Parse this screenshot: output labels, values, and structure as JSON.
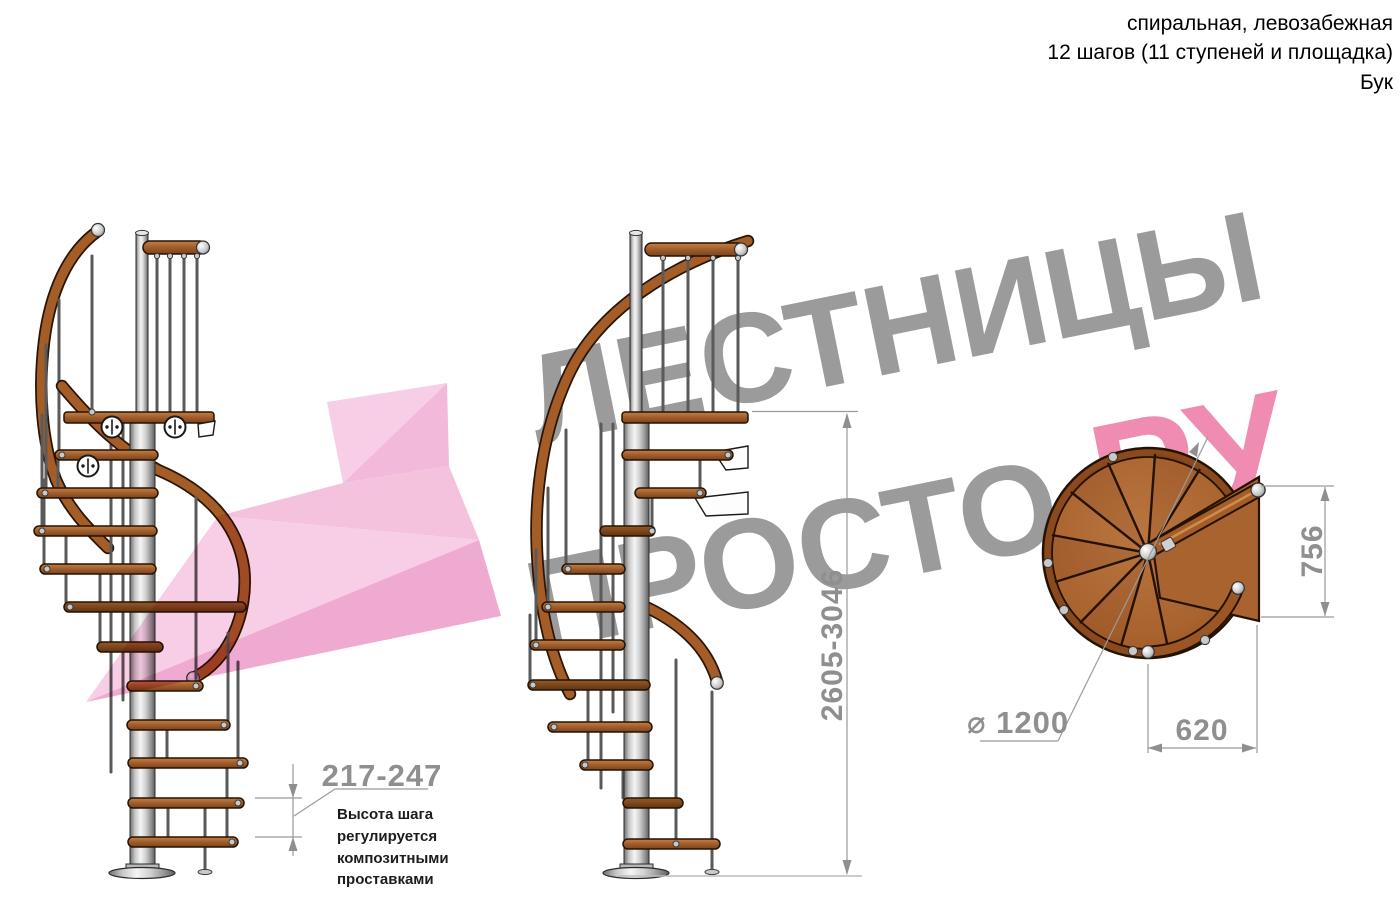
{
  "header": {
    "text": "спиральная, левозабежная\n12 шагов (11 ступеней и площадка)\nБук"
  },
  "watermark": {
    "line1": "ЛЕСТНИЦЫ",
    "line2": "ПРОСТО",
    "accent": ".РУ"
  },
  "dimensions": {
    "total_height": "2605-3046",
    "landing_depth": "756",
    "landing_width": "620",
    "diameter": "⌀ 1200",
    "step_height": "217-247"
  },
  "note": {
    "text": "Высота шага\nрегулируется\nкомпозитными\nпроставками"
  },
  "colors": {
    "accent_pink": "#f08cb2",
    "watermark_gray": "#9b9b9b",
    "wood": "#a55d28",
    "metal_gray": "#c9c9c9",
    "dimension_gray": "#8f8f8f",
    "arrow_pink": "#f4bbdb"
  }
}
